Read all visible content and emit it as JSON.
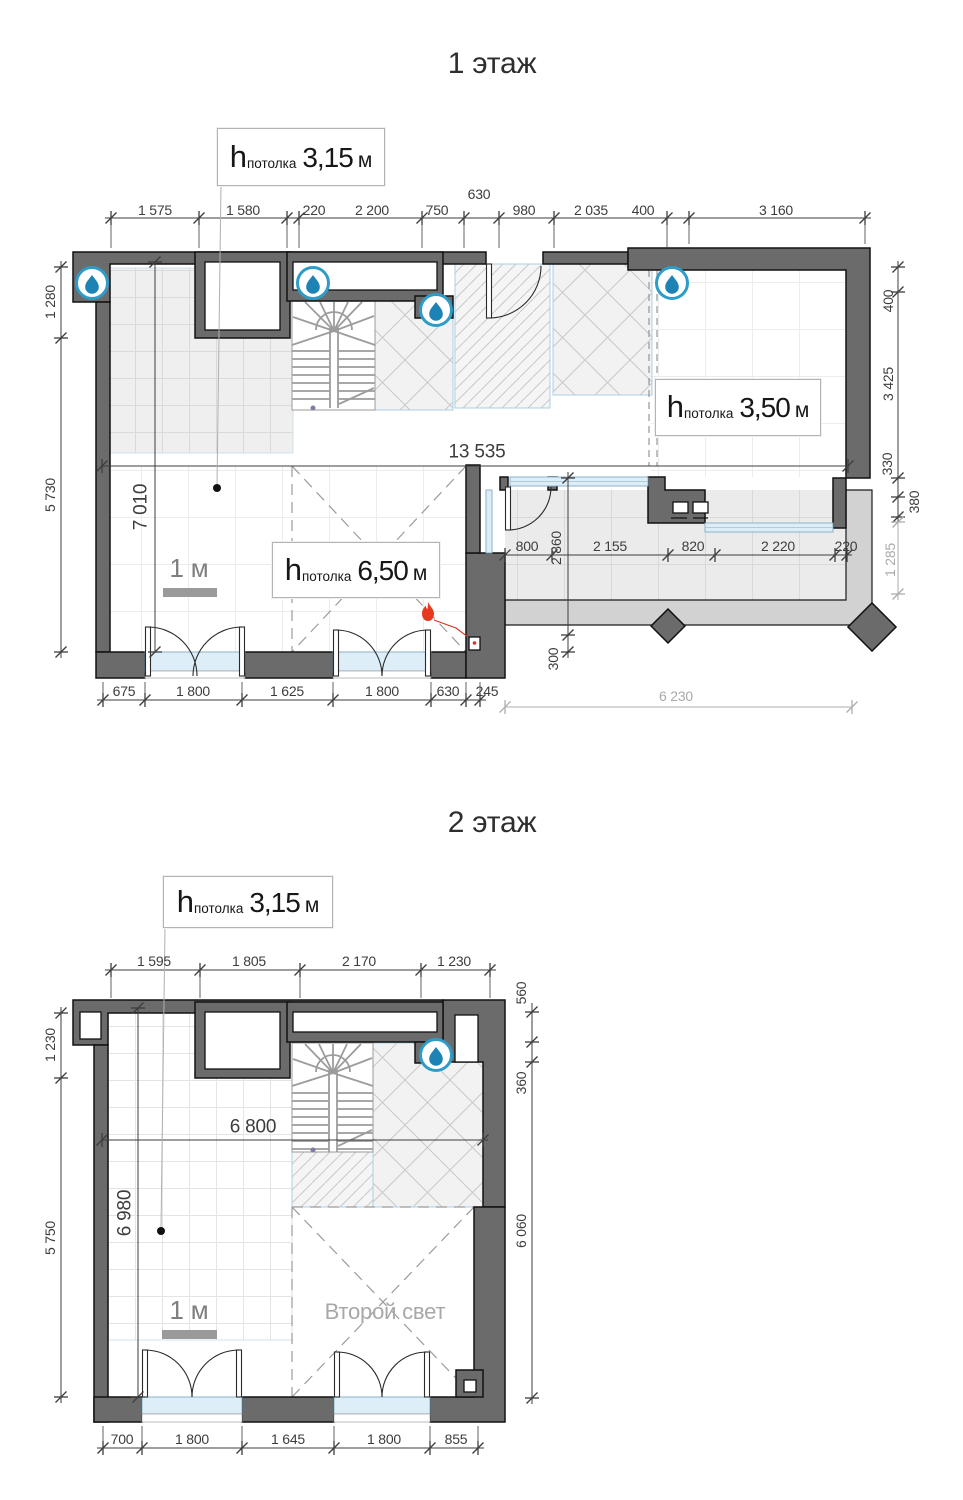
{
  "sheet": {
    "width": 963,
    "height": 1500
  },
  "ceiling": {
    "prefix": "h",
    "sub": "потолка",
    "unit": "м"
  },
  "icons": {
    "water_drop": "water-supply-point",
    "fire": "gas-heat-point"
  },
  "colors": {
    "wall": "#6b6b6b",
    "wall_stroke": "#121212",
    "dim_text": "#3d3d3d",
    "dim_gray": "#a9a9a9",
    "glass": "#ddeef8",
    "slab": "#d2d2d2",
    "drop_ring": "#2e9cc7",
    "drop_fill": "#1d83b5",
    "fire": "#e63a1e"
  },
  "floor1": {
    "title": "1 этаж",
    "ceilings": [
      "3,15",
      "3,50",
      "6,50"
    ],
    "scale_label": "1 м",
    "dims": {
      "top": [
        "1 575",
        "1 580",
        "220",
        "2 200",
        "750",
        "630",
        "980",
        "2 035",
        "400",
        "3 160"
      ],
      "left": [
        "1 280",
        "5 730"
      ],
      "right": [
        "400",
        "3 425",
        "330",
        "380",
        "1 285"
      ],
      "inner_width": "13 535",
      "inner_height": "7 010",
      "terrace": [
        "800",
        "2 155",
        "820",
        "2 220",
        "220"
      ],
      "terrace_depth": "2 860",
      "terrace_offset": "300",
      "terrace_width": "6 230",
      "bottom": [
        "675",
        "1 800",
        "1 625",
        "1 800",
        "630",
        "245"
      ]
    }
  },
  "floor2": {
    "title": "2 этаж",
    "ceilings": [
      "3,15"
    ],
    "scale_label": "1 м",
    "void_label": "Второй свет",
    "dims": {
      "top": [
        "1 595",
        "1 805",
        "2 170",
        "1 230"
      ],
      "left": [
        "1 230",
        "5 750"
      ],
      "right": [
        "560",
        "360",
        "6 060"
      ],
      "inner_width": "6 800",
      "inner_height": "6 980",
      "bottom": [
        "700",
        "1 800",
        "1 645",
        "1 800",
        "855"
      ]
    }
  }
}
